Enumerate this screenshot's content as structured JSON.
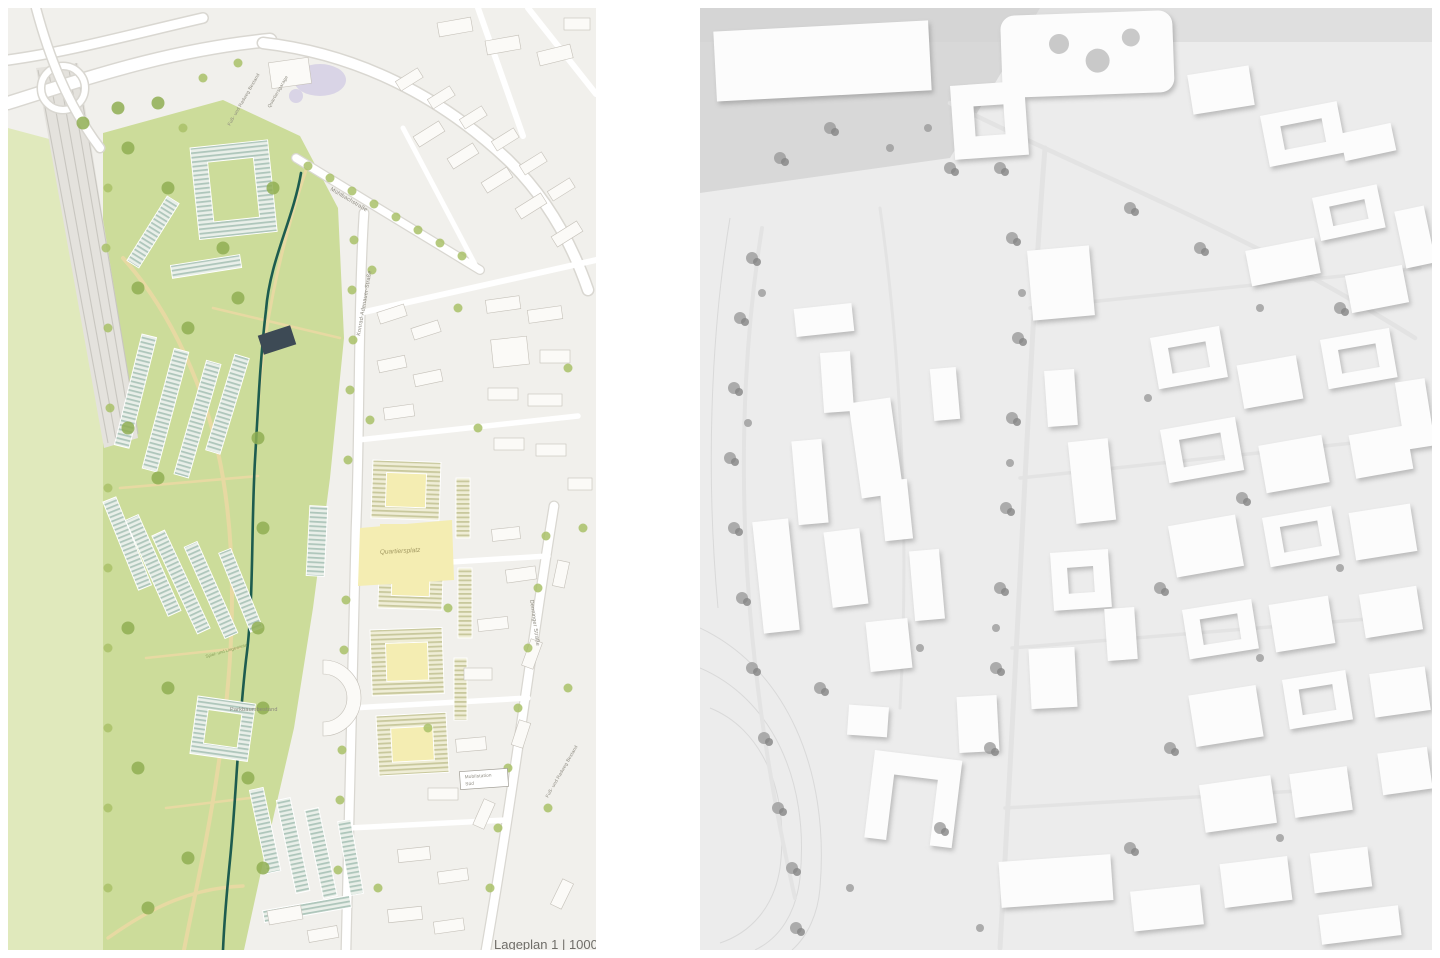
{
  "site_plan": {
    "caption": "Lageplan 1 | 1000",
    "labels": {
      "path_top": "Fuß- und Radweg Bestand",
      "garage": "Quartiersgarage",
      "street_upper": "Mühlbachstraße",
      "street_main": "Konrad-Adenauer-Straße",
      "plaza": "Quartiersplatz",
      "street_right": "Denninger Straße",
      "park_trees": "Parkbaumbestand",
      "meadow": "Spiel- und Liegewiese",
      "mobility_line1": "Mobilstation",
      "mobility_line2": "Süd",
      "path_bottom": "Fuß- und Radweg Bestand"
    }
  },
  "colors": {
    "urban_bg": "#f1f0ec",
    "meadow_green": "#e0e9bc",
    "park_green": "#ccdc9a",
    "rail_grey": "#c8c6c0",
    "road_casing": "#d9d7d1",
    "path_beige": "#e7d9a2",
    "stream_teal": "#1d5c4f",
    "tree_green": "#a9c168",
    "tree_dark": "#8fae52",
    "building_white": "#fbfaf7",
    "building_grey": "#c5c1b9",
    "plaza_yellow": "#f4edb2",
    "pool_lavender": "#d9d4e6",
    "label_grey": "#8b887e",
    "model_bg": "#ececec",
    "model_white": "#fcfcfc",
    "model_shadow": "#c9c9c9",
    "model_tree": "#9b9b9b"
  }
}
